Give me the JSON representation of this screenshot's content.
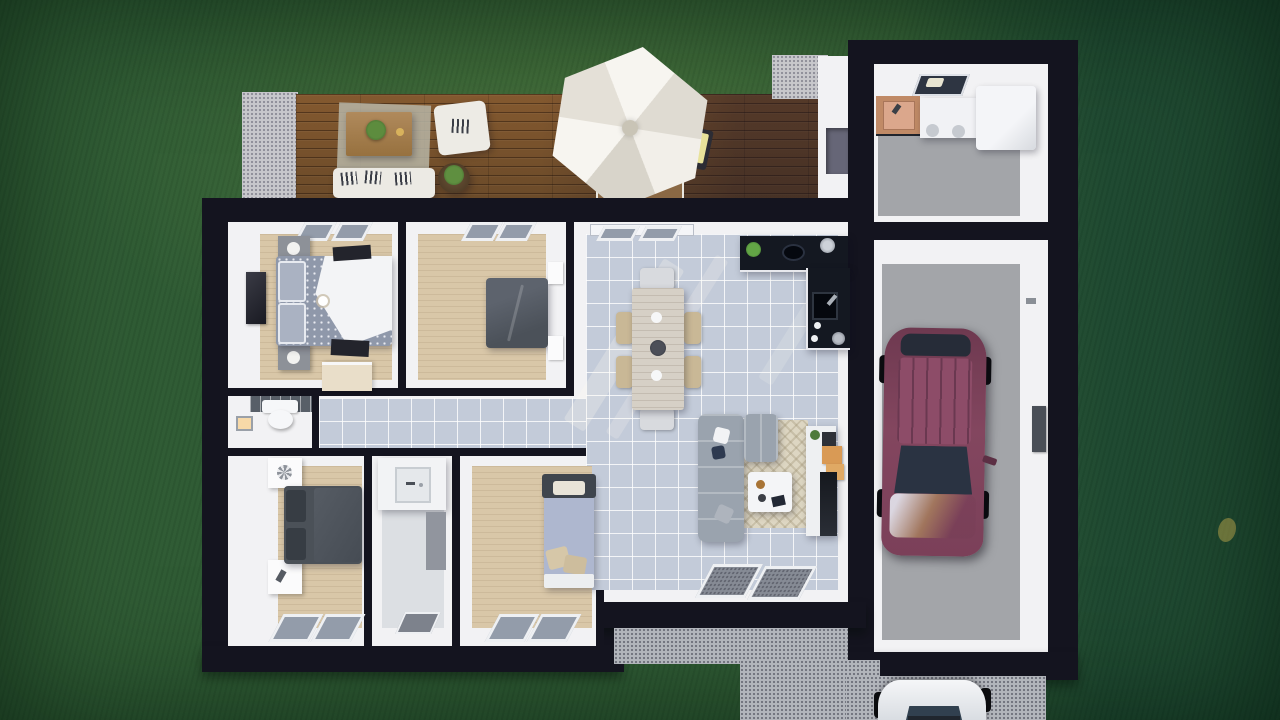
{
  "scene": {
    "title": "Top-down 3D rendering of a single-storey house floor plan on a lawn",
    "view": "aerial cutaway (roof removed)",
    "environment": {
      "lawn": "dark green grass surrounding the house, darker toward right and corners",
      "deck": "brown wooden plank terrace along the top of the house",
      "concrete_pads": [
        "small speckled pad at left end of deck",
        "small speckled pad right of deck"
      ],
      "gravel_path": "gray gravel strip outside the living-room south wall",
      "driveway": "gray driveway leaving the garage at bottom right"
    },
    "rooms": [
      {
        "id": "terrace",
        "name": "Wooden deck terrace",
        "furniture": [
          "white outdoor sofa with striped cushions",
          "white armchair",
          "large wooden coffee table with green plant",
          "round dark side table with plant",
          "white hexagonal parasol",
          "sun loungers with yellow cushions",
          "outdoor dining table under parasol"
        ]
      },
      {
        "id": "utility-room",
        "name": "Utility room (top-right wing)",
        "furniture": [
          "wooden sink counter",
          "washer and dryer units",
          "large white storage/boiler unit",
          "skylight"
        ]
      },
      {
        "id": "garage",
        "name": "Garage",
        "furniture": [
          "dark-red car parked facing the door",
          "small dark wall panel"
        ]
      },
      {
        "id": "master-bedroom",
        "name": "Master bedroom (top left)",
        "furniture": [
          "double bed with patterned duvet and white throw",
          "two gray nightstands with round lamps",
          "wall-mounted TV",
          "two dark rugs",
          "low closet"
        ]
      },
      {
        "id": "bedroom-2",
        "name": "Bedroom 2 (top middle)",
        "furniture": [
          "double bed with dark gray duvet",
          "white wall shelves"
        ]
      },
      {
        "id": "living-dining-kitchen",
        "name": "Open living / dining room with kitchen",
        "furniture": [
          "L-shaped black kitchen counter with sink, hob, plant and pots",
          "light wooden dining table with six chairs",
          "L-shaped light gray sofa with cushions",
          "beige area rug",
          "white coffee table with tray",
          "white TV sideboard with orange boxes",
          "two gray doormats at the entrance"
        ]
      },
      {
        "id": "wc",
        "name": "WC",
        "furniture": [
          "toilet against dark tiled wall",
          "small wall light"
        ]
      },
      {
        "id": "hallway",
        "name": "Hallway (tiled, connects bedrooms to living room)",
        "furniture": []
      },
      {
        "id": "bedroom-3",
        "name": "Bedroom 3 (bottom left)",
        "furniture": [
          "double bed with dark gray duvet",
          "two white nightstands",
          "two south-facing windows"
        ]
      },
      {
        "id": "bathroom",
        "name": "Bathroom (bottom middle)",
        "furniture": [
          "white vanity with square sink",
          "gray bath mat"
        ]
      },
      {
        "id": "bedroom-4",
        "name": "Bedroom 4 (bottom middle-right)",
        "furniture": [
          "bed with light blue duvet and beige pillows",
          "dark headboard shelf with white cushion",
          "two south-facing windows"
        ]
      }
    ],
    "vehicles": [
      {
        "id": "car-garage",
        "name": "Dark red car parked inside the garage, facing south"
      },
      {
        "id": "car-driveway",
        "name": "White car on the driveway below the garage, partially visible"
      }
    ],
    "palette": {
      "grass": "#2e5a33",
      "wall": "#14141f",
      "floor_white": "#f2f2f4",
      "floor_beige": "#d9c7a8",
      "floor_tile": "#c3cbd9",
      "floor_gray": "#a3a5a9",
      "deck_wood": "#7d5531",
      "concrete": "#c7c7cb",
      "gravel": "#b2b5bb",
      "counter_black": "#141821",
      "rug_beige": "#ddd6c2",
      "sofa_gray": "#9aa3ae",
      "bed_dark": "#565c66",
      "bed_blue": "#aeb7cf",
      "car_maroon": "#7b4059",
      "car_white": "#eef0f3",
      "umbrella_white": "#efede7",
      "wood_counter": "#c08a66"
    }
  }
}
